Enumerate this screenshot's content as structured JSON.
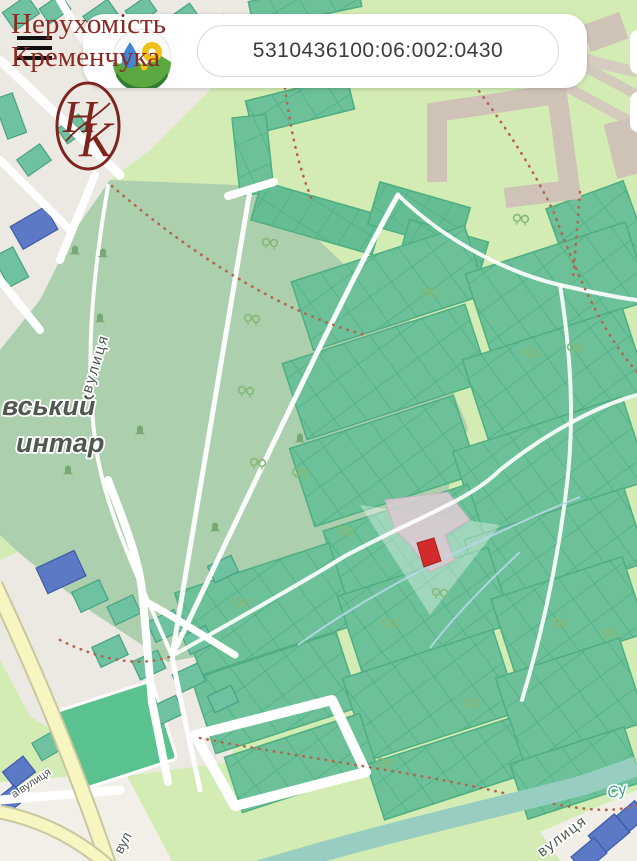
{
  "header": {
    "brand": {
      "line1": "Нерухомість",
      "line2": "Кременчука"
    },
    "search": {
      "value": "5310436100:06:002:0430"
    },
    "emblem": {
      "l1": "Н",
      "l2": "К"
    }
  },
  "map": {
    "labels": {
      "cemetery_line1": "вський",
      "cemetery_line2": "интар",
      "street_left_vertical": "вулиця",
      "street_bottom_left": "а вулиця",
      "street_yellow_road": "вул",
      "street_bottom_right": "вулиця",
      "stream_bottom_right": "Су"
    },
    "selected_parcel": {
      "cadastral_number": "5310436100:06:002:0430",
      "highlight_color": "#d32b2b"
    },
    "colors": {
      "brand_red": "#8b2a22",
      "parcel_green": "#6cc199",
      "cemetery_green": "#accfad",
      "base_green": "#d3ecb3",
      "water_teal": "#98cec1",
      "road_yellow": "#f7f5c0",
      "building_tan": "#cfc3b7",
      "parcel_blue": "#5b79c5"
    }
  }
}
